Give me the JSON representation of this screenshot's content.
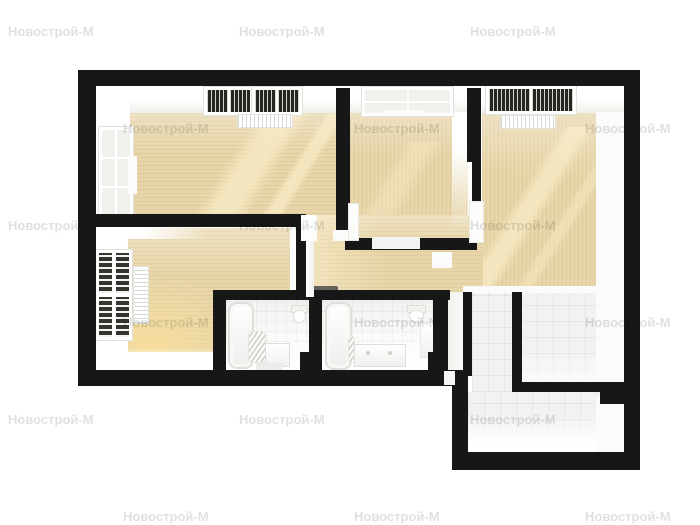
{
  "watermark": {
    "text": "Новострой-М",
    "color": "rgba(0,0,0,0.12)",
    "font_size_px": 13,
    "positions": [
      [
        8,
        24
      ],
      [
        239,
        24
      ],
      [
        470,
        24
      ],
      [
        123,
        121
      ],
      [
        354,
        121
      ],
      [
        585,
        121
      ],
      [
        8,
        218
      ],
      [
        239,
        218
      ],
      [
        470,
        218
      ],
      [
        123,
        315
      ],
      [
        354,
        315
      ],
      [
        585,
        315
      ],
      [
        8,
        412
      ],
      [
        239,
        412
      ],
      [
        470,
        412
      ],
      [
        123,
        509
      ],
      [
        354,
        509
      ],
      [
        585,
        509
      ]
    ]
  },
  "palette": {
    "background": "#ffffff",
    "wall": "#171717",
    "wood": "#e8d6aa",
    "tile": "#f2f2f0",
    "white_face": "#fbfbfb",
    "sun": "rgba(255,243,208,0.55)",
    "mat": "#63635c",
    "wmcolor": "rgba(0,0,0,0.12)"
  },
  "plan": {
    "type": "apartment-floor-plan-3d-top-down",
    "rooms": [
      {
        "id": "living-room",
        "position": "top-left",
        "floor": "light-wood",
        "features": [
          "side-window",
          "two-ceiling-windows",
          "radiator"
        ]
      },
      {
        "id": "bedroom-middle",
        "position": "top-middle",
        "floor": "light-wood",
        "features": [
          "ceiling-window"
        ]
      },
      {
        "id": "bedroom-right",
        "position": "top-right",
        "floor": "light-wood",
        "features": [
          "ceiling-window",
          "radiator"
        ]
      },
      {
        "id": "bedroom-lower-left",
        "position": "bottom-left",
        "floor": "light-wood",
        "features": [
          "blinds-window",
          "radiator"
        ]
      },
      {
        "id": "corridor",
        "position": "center",
        "floor": "light-wood",
        "features": [
          "doormat"
        ]
      },
      {
        "id": "bathroom-1",
        "position": "bottom-center-left",
        "floor": "white",
        "features": [
          "bathtub",
          "toilet",
          "towel-ladder",
          "washing-machine"
        ]
      },
      {
        "id": "bathroom-2",
        "position": "bottom-center",
        "floor": "white",
        "features": [
          "bathtub",
          "toilet",
          "double-vanity",
          "drying-rack"
        ]
      },
      {
        "id": "kitchen",
        "position": "right",
        "floor": "white-tile",
        "features": []
      },
      {
        "id": "entry-hall",
        "position": "bottom-right",
        "floor": "white-tile",
        "features": []
      }
    ]
  }
}
